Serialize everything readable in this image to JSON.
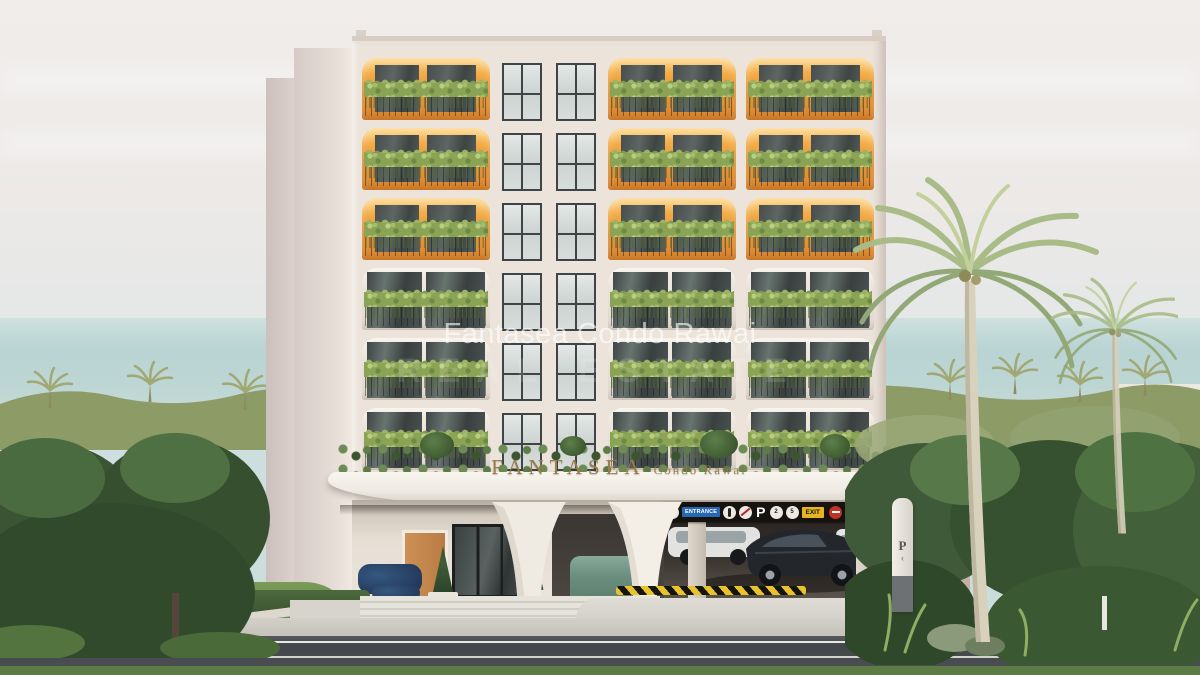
{
  "meta": {
    "type": "3d-architectural-render",
    "subject": "Fantasea Condo Rawai — low-rise condominium exterior with entrance canopy, parking garage and tropical landscaping"
  },
  "watermark": {
    "line1": "Fantasea Condo Rawai",
    "line2": "REAL ESTATE"
  },
  "canopy_sign": {
    "brand": "FANTASEA",
    "suffix": "Condo Rawai"
  },
  "parking_sign": {
    "speed_limit": "10",
    "entrance": "ENTRANCE",
    "parking_symbol": "P",
    "bay_numbers": [
      "2",
      "5"
    ],
    "exit": "EXIT"
  },
  "pylon_sign": {
    "letter": "P",
    "arrow": "‹"
  },
  "building": {
    "floor_styles": [
      "orange",
      "orange",
      "orange",
      "neutral",
      "neutral",
      "neutral"
    ],
    "bays_per_floor": 3,
    "stairwell_windows_per_floor": 2,
    "colors": {
      "facade": "#ece4db",
      "arch_accent": "#ef9f3c",
      "glass": "#454c4a",
      "planter_green": "#8aa355",
      "canopy": "#f3efe8",
      "roof_garden": "#4c673d"
    }
  },
  "environment": {
    "sky": "#eeebe9",
    "sea": "#bad4d3",
    "foliage_dark": "#3b5434",
    "foliage_light": "#4f7043",
    "road": "#45494d",
    "grass": "#5c7b45"
  }
}
